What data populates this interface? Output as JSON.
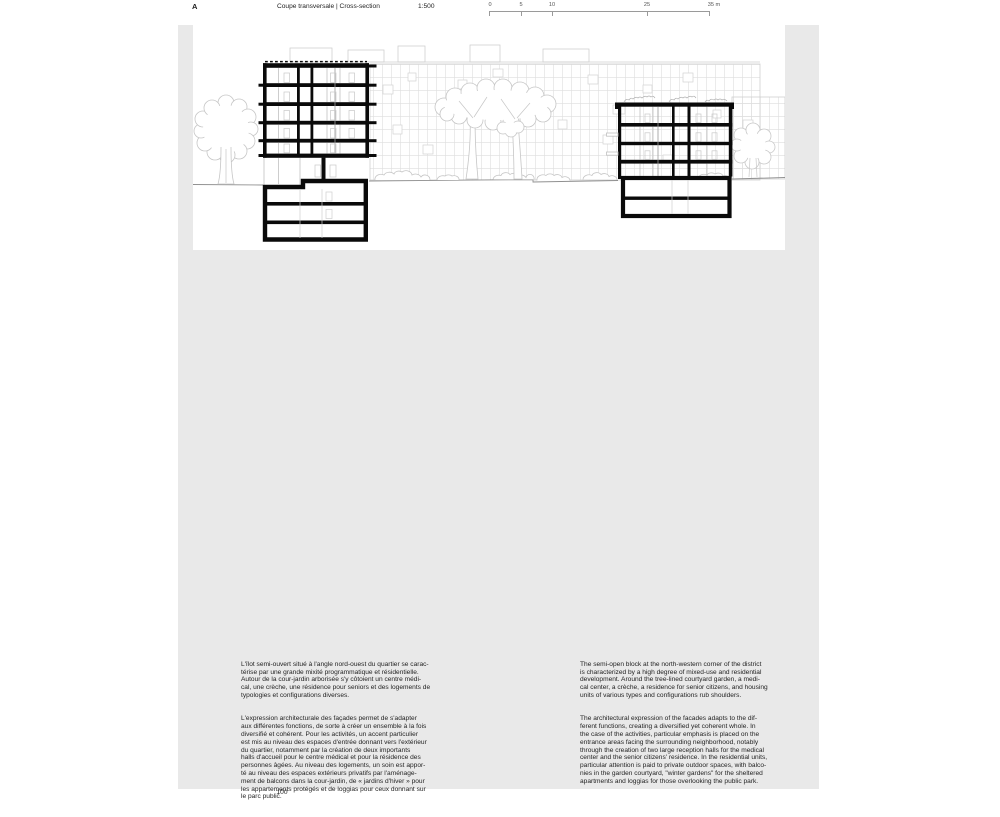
{
  "header": {
    "section_label": "A",
    "title": "Coupe transversale | Cross-section",
    "scale_label": "1:500",
    "scale_ticks": [
      "0",
      "5",
      "10",
      "25",
      "35 m"
    ]
  },
  "drawing": {
    "description": "architectural cross-section: two section-cut buildings in black with basements, background facade elevation, trees and shrubs in light gray"
  },
  "body": {
    "french": {
      "p1": "L'îlot semi-ouvert situé à l'angle nord-ouest du quartier se carac-\ntérise par une grande mixité programmatique et résidentielle.\nAutour de la cour-jardin arborisée s'y côtoient un centre médi-\ncal, une crèche, une résidence pour seniors et des logements de\ntypologies et configurations diverses.",
      "p2": "L'expression architecturale des façades permet de s'adapter\naux différentes fonctions, de sorte à créer un ensemble à la fois\ndiversifié et cohérent. Pour les activités, un accent particulier\nest mis au niveau des espaces d'entrée donnant vers l'extérieur\ndu quartier, notamment par la création de deux importants\nhalls d'accueil pour le centre médical et pour la résidence des\npersonnes âgées. Au niveau des logements, un soin est appor-\nté au niveau des espaces extérieurs privatifs par l'aménage-\nment de balcons dans la cour-jardin, de « jardins d'hiver » pour\nles appartements protégés et de loggias pour ceux donnant sur\nle parc public."
    },
    "english": {
      "p1": "The semi-open block at the north-western corner of the district\nis characterized by a high degree of mixed-use and residential\ndevelopment. Around the tree-lined courtyard garden, a medi-\ncal center, a crèche, a residence for senior citizens, and housing\nunits of various types and configurations rub shoulders.",
      "p2": "The architectural expression of the facades adapts to the dif-\nferent functions, creating a diversified yet coherent whole. In\nthe case of the activities, particular emphasis is placed on the\nentrance areas facing the surrounding neighborhood, notably\nthrough the creation of two large reception halls for the medical\ncenter and the senior citizens' residence. In the residential units,\nparticular attention is paid to private outdoor spaces, with balco-\nnies in the garden courtyard, \"winter gardens\" for the sheltered\napartments and loggias for those overlooking the public park."
    }
  },
  "footer": {
    "page_number": "100"
  },
  "colors": {
    "page_gray": "#e9e9e9",
    "ink_black": "#0a0a0a",
    "drawing_light_gray": "#c9c9c9",
    "ground_gray": "#909090"
  }
}
